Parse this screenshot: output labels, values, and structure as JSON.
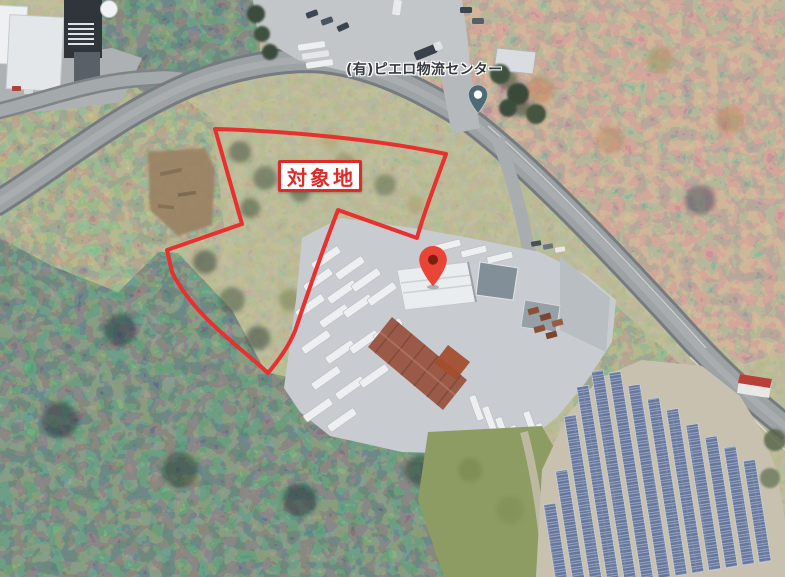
{
  "map": {
    "view": "satellite-aerial",
    "place_label": {
      "text": "(有)ピエロ物流センター",
      "color": "#35383c"
    },
    "target_label": {
      "text": "対象地",
      "color": "#dd2b28",
      "background": "#ffffff",
      "border_color": "#dd2b28"
    },
    "outline": {
      "color": "#e8302e",
      "width_px": 4
    },
    "red_pin": {
      "icon": "map-pin-icon",
      "color": "#e94435",
      "inner_color": "#7e1d12"
    },
    "poi_pin": {
      "icon": "location-pin-icon",
      "color": "#4e6a76",
      "inner_color": "#ffffff"
    }
  }
}
